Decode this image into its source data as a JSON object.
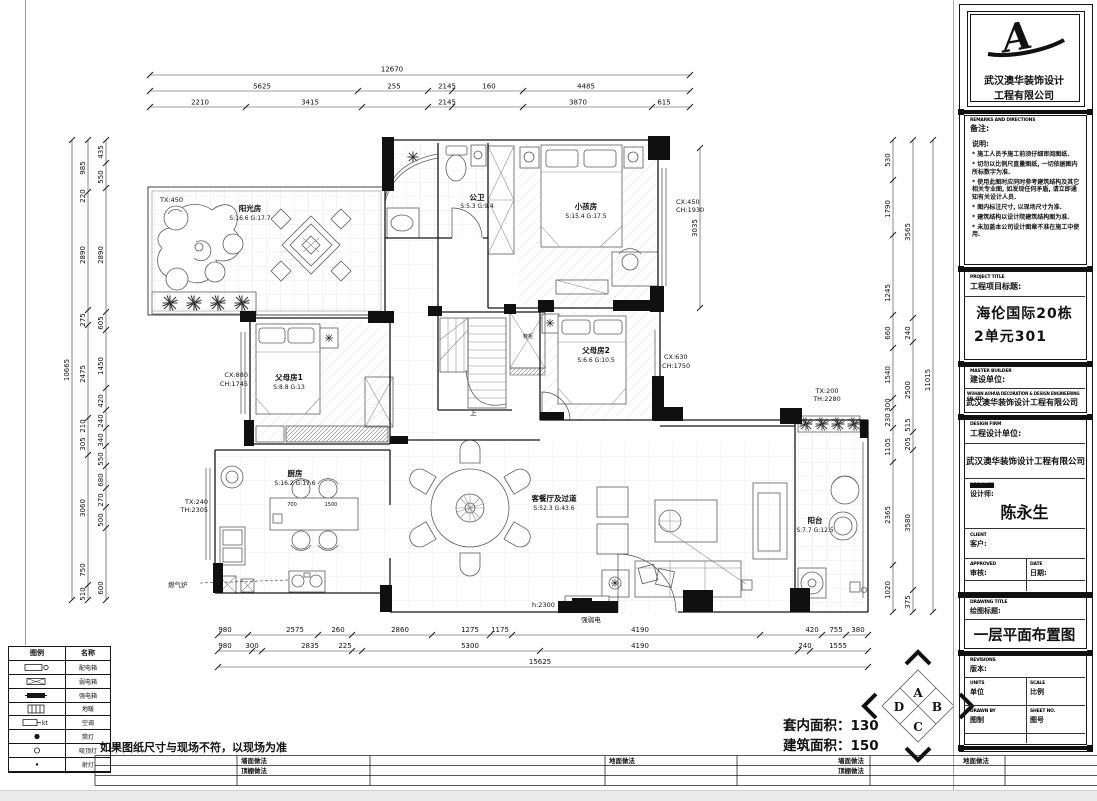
{
  "meta": {
    "paper": "#ffffff",
    "ink": "#111111",
    "grid": "#d6d6d6",
    "chrome": "#ececec"
  },
  "plan": {
    "rooms": {
      "sunroom": {
        "name": "阳光房",
        "area": "S:16.6 G:17.7",
        "win": "TX:450"
      },
      "bath": {
        "name": "公卫",
        "area": "S:5.3 G:9.4"
      },
      "kids": {
        "name": "小孩房",
        "area": "S:15.4 G:17.5",
        "cx": "CX:450",
        "ch": "CH:1930"
      },
      "parents1": {
        "name": "父母房1",
        "area": "S:8.8 G:13",
        "cx": "CX:880",
        "ch": "CH:1745"
      },
      "parents2": {
        "name": "父母房2",
        "area": "S:6.6 G:10.5",
        "cx": "CX:630",
        "ch": "CH:1750"
      },
      "living": {
        "name": "客餐厅及过道",
        "area": "S:52.3 G:43.6"
      },
      "kitchen": {
        "name": "厨房",
        "area": "S:16.2 G:17.6",
        "tx": "TX:240",
        "th": "TH:2305"
      },
      "balcony": {
        "name": "阳台",
        "area": "S:7.7 G:12.5",
        "tx": "TX:200",
        "th": "TH:2280"
      }
    },
    "fixtures": {
      "gas_stove": "燃气炉",
      "elec_box": "强弱电",
      "door_height": "h:2300",
      "stairs_up": "上",
      "shoe_cabinet": "鞋柜"
    },
    "dims": {
      "top_total": "12670",
      "top_mid": [
        "5625",
        "255",
        "2145",
        "160",
        "4485"
      ],
      "top_inner": [
        "2210",
        "3415",
        "2145",
        "3870",
        "615"
      ],
      "left_total": "10665",
      "left_outer": [
        "985",
        "220",
        "2890",
        "275",
        "2475",
        "210",
        "305",
        "3060",
        "750",
        "510"
      ],
      "left_inner": [
        "435",
        "550",
        "2890",
        "605",
        "1450",
        "420",
        "240",
        "340",
        "550",
        "680",
        "270",
        "500",
        "600"
      ],
      "right_total": "11015",
      "right_inner": [
        "530",
        "1790",
        "1245",
        "660",
        "1540",
        "300",
        "230",
        "1105",
        "2365",
        "1020"
      ],
      "right_mid": [
        "3565",
        "240",
        "2500",
        "515",
        "205",
        "3580",
        "375"
      ],
      "kids_height": "3035",
      "bottom_inner": [
        "980",
        "2575",
        "260",
        "2860",
        "1275",
        "1175",
        "4190",
        "420",
        "755",
        "380"
      ],
      "bottom_mid": [
        "980",
        "300",
        "2835",
        "225",
        "5300",
        "4190",
        "240",
        "1555"
      ],
      "bottom_total": "15625",
      "island": [
        "700",
        "1500"
      ]
    }
  },
  "summary": {
    "net": "套内面积：130",
    "gross": "建筑面积：150"
  },
  "compass": {
    "top": "A",
    "right": "B",
    "bottom": "C",
    "left": "D"
  },
  "site_note": "如果图纸尺寸与现场不符，以现场为准",
  "legend": {
    "headers": {
      "symbol": "图例",
      "name": "名称"
    },
    "kt": "kt",
    "rows": [
      {
        "name": "配电箱"
      },
      {
        "name": "弱电箱"
      },
      {
        "name": "强电箱"
      },
      {
        "name": "地暖"
      },
      {
        "name": "空调"
      },
      {
        "name": "筒灯"
      },
      {
        "name": "吸顶灯"
      },
      {
        "name": "射灯"
      }
    ]
  },
  "schedule": {
    "wall": "墙面做法",
    "ceiling": "顶棚做法",
    "floor": "地面做法"
  },
  "titleblock": {
    "company_line1": "武汉澳华装饰设计",
    "company_line2": "工程有限公司",
    "logo_glyph": "A",
    "remarks_en": "REMARKS AND DIRECTIONS",
    "remarks_label": "备注:",
    "notes_title": "说明:",
    "notes": [
      "* 施工人员予施工前须仔细审阅图纸.",
      "* 切勿以比例尺直量图纸, 一切依据图内所标数字为准.",
      "* 使用此图时应同时参考建筑结构及其它相关专业图, 如发现任何矛盾, 请立即通知有关设计人员.",
      "* 图内标注尺寸, 以现场尺寸为准.",
      "* 建筑结构以设计院建筑结构图为准.",
      "* 未加盖本公司设计图章不准在施工中使用."
    ],
    "project_en": "PROJECT TITLE",
    "project_label": "工程项目标题:",
    "project_line1": "海伦国际20栋",
    "project_line2": "2单元301",
    "builder_en": "MASTER BUILDER",
    "builder_label": "建设单位:",
    "builder_name_en": "WUHAN AOHUA DECORATION & DESIGN ENGINEERING CO.,LTD",
    "builder_name": "武汉澳华装饰设计工程有限公司",
    "design_en": "DESIGN FIRM",
    "design_label": "工程设计单位:",
    "design_name": "武汉澳华装饰设计工程有限公司",
    "designer_en": "DESIGNER",
    "designer_label": "设计师:",
    "designer_name": "陈永生",
    "client_en": "CLIENT",
    "client_label": "客户:",
    "approved_en": "APPROVED",
    "approved_label": "审核:",
    "date_en": "DATE",
    "date_label": "日期:",
    "drawing_en": "DRAWING TITLE",
    "drawing_label": "绘图标题:",
    "drawing_title": "一层平面布置图",
    "revisions_en": "REVISIONS",
    "revisions_label": "版本:",
    "units_en": "UNITS",
    "units_label": "单位",
    "scale_en": "SCALE",
    "scale_label": "比例",
    "drawn_en": "DRAWN BY",
    "drawn_label": "图制",
    "sheet_en": "SHEET NO.",
    "sheet_label": "图号"
  }
}
